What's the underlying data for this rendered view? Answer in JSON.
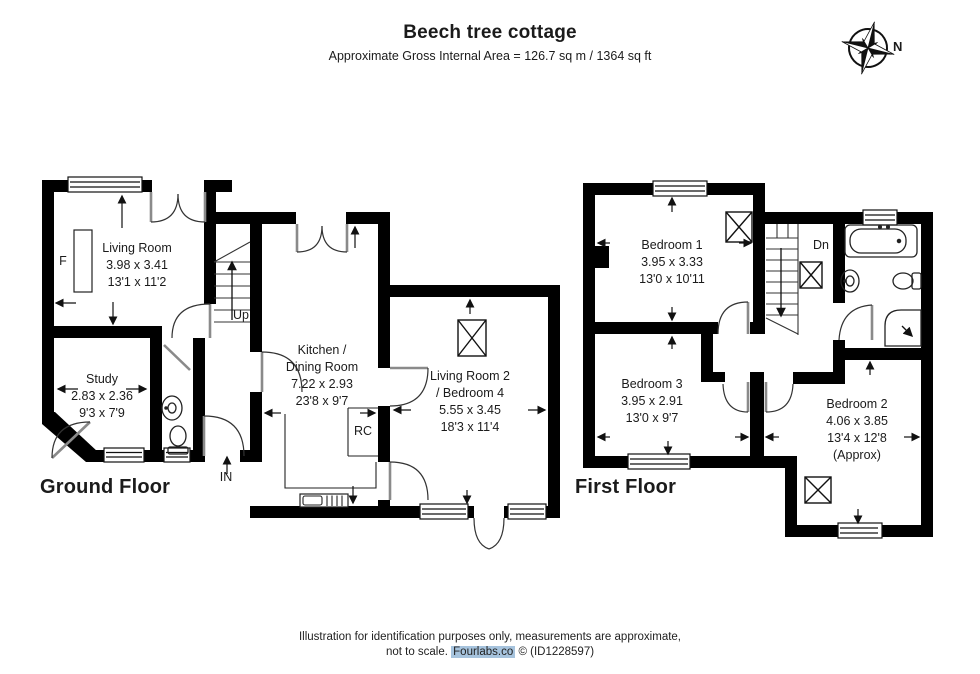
{
  "header": {
    "title": "Beech tree cottage",
    "subtitle": "Approximate Gross Internal Area = 126.7 sq m / 1364 sq ft"
  },
  "compass": {
    "north_label": "N"
  },
  "ground_floor": {
    "label": "Ground Floor",
    "rooms": [
      {
        "name": "Living Room",
        "metric": "3.98 x 3.41",
        "imperial": "13'1 x 11'2"
      },
      {
        "name": "Study",
        "metric": "2.83 x 2.36",
        "imperial": "9'3 x 7'9"
      },
      {
        "name": "Kitchen /",
        "name2": "Dining Room",
        "metric": "7.22 x 2.93",
        "imperial": "23'8 x 9'7"
      },
      {
        "name": "Living Room 2",
        "name2": "/ Bedroom 4",
        "metric": "5.55 x 3.45",
        "imperial": "18'3 x 11'4"
      }
    ],
    "annotations": {
      "fireplace": "F",
      "stairs_up": "Up",
      "entrance": "IN",
      "range_cooker": "RC"
    }
  },
  "first_floor": {
    "label": "First Floor",
    "rooms": [
      {
        "name": "Bedroom 1",
        "metric": "3.95 x 3.33",
        "imperial": "13'0 x 10'11"
      },
      {
        "name": "Bedroom 3",
        "metric": "3.95 x 2.91",
        "imperial": "13'0 x 9'7"
      },
      {
        "name": "Bedroom 2",
        "metric": "4.06 x 3.85",
        "imperial": "13'4 x 12'8",
        "note": "(Approx)"
      }
    ],
    "annotations": {
      "stairs_down": "Dn"
    }
  },
  "footer": {
    "line1": "Illustration for identification purposes only, measurements are approximate,",
    "line2_prefix": "not to scale.",
    "brand": "Fourlabs.co",
    "line2_suffix": "© (ID1228597)"
  }
}
